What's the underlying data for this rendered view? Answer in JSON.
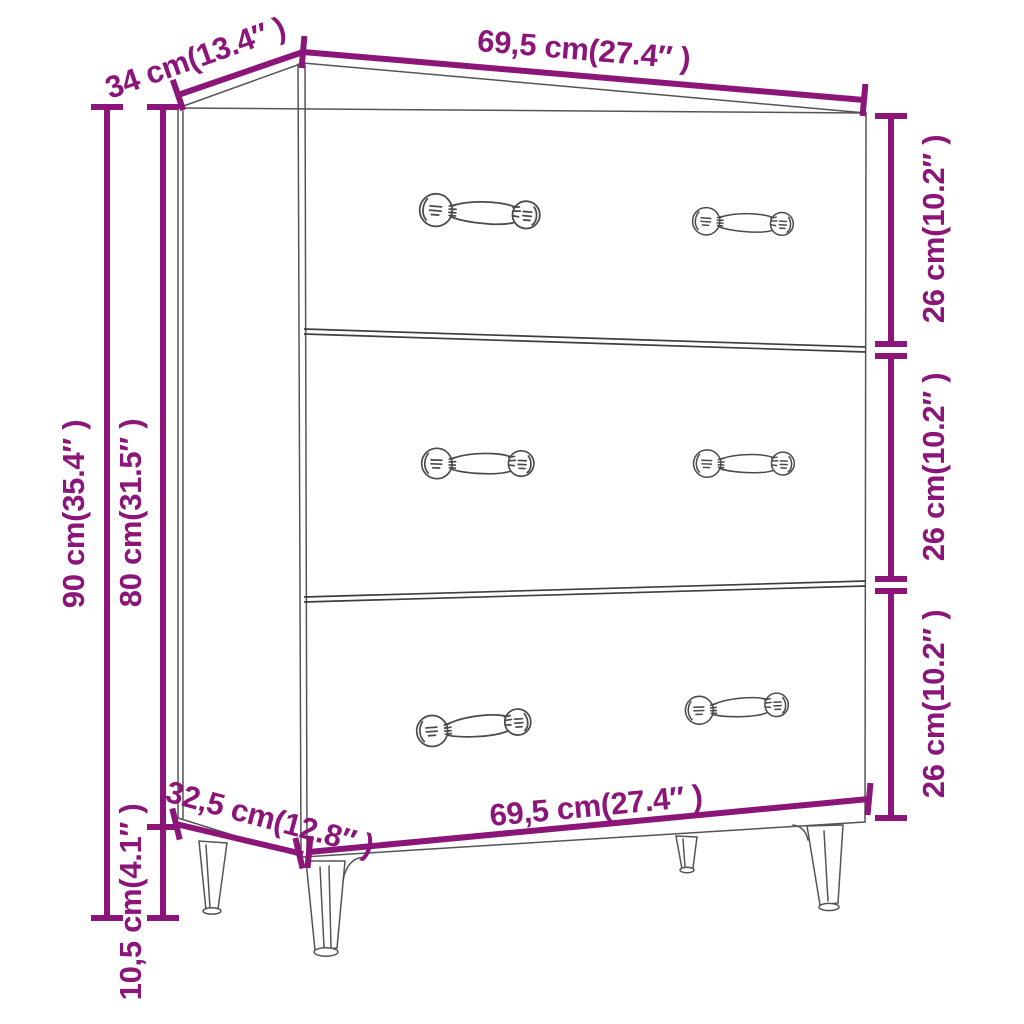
{
  "diagram": {
    "subject": "three-drawer sideboard outline drawing with dimension annotations",
    "colors": {
      "dimension_accent": "#8b1579",
      "outline_gray": "#555555",
      "divider_gray": "#3e3e3e",
      "background": "#ffffff"
    },
    "labels": {
      "width_top": "69,5 cm(27.4″ )",
      "depth_top": "34 cm(13.4″ )",
      "drawer1_height": "26 cm(10.2″ )",
      "drawer2_height": "26 cm(10.2″ )",
      "drawer3_height": "26 cm(10.2″ )",
      "height_total": "90 cm(35.4″ )",
      "height_body": "80 cm(31.5″ )",
      "depth_bottom": "32,5 cm(12.8″ )",
      "leg_height": "10,5 cm(4.1″ )",
      "width_bottom": "69,5 cm(27.4″ )"
    }
  }
}
